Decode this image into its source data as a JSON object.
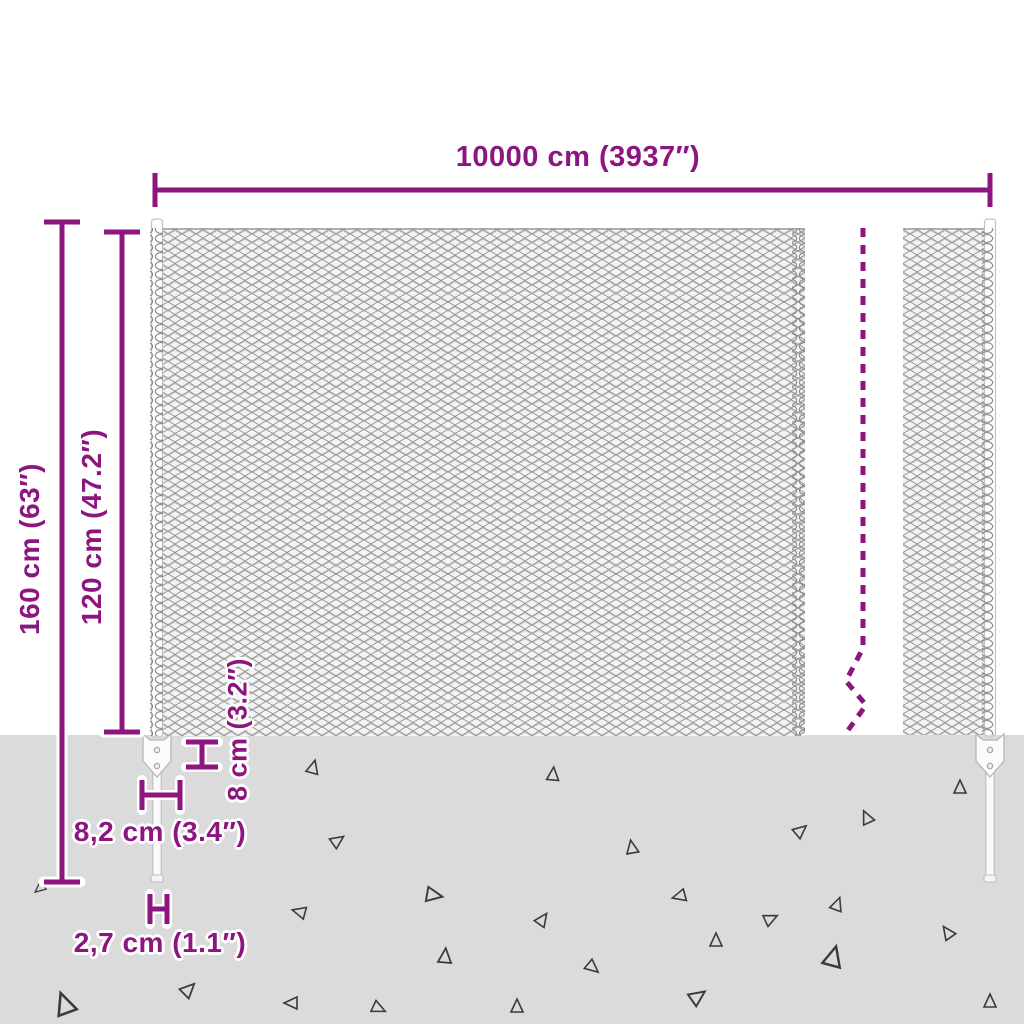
{
  "diagram": {
    "subject": "chain-link fence with posts and ground anchors - dimension diagram",
    "labels": {
      "total_length": "10000 cm (3937″)",
      "total_height": "160 cm (63″)",
      "mesh_height": "120 cm (47.2″)",
      "anchor_plate_height": "8 cm (3.2″)",
      "anchor_plate_width": "8,2 cm (3.4″)",
      "post_diameter": "2,7 cm (1.1″)"
    },
    "colors": {
      "dimension_accent": "#8c1580",
      "ground": "#dbdbdb",
      "mesh_wire": "#8e8e8e",
      "post_fill": "#ffffff",
      "debris_outline": "#3a3a3a"
    }
  }
}
